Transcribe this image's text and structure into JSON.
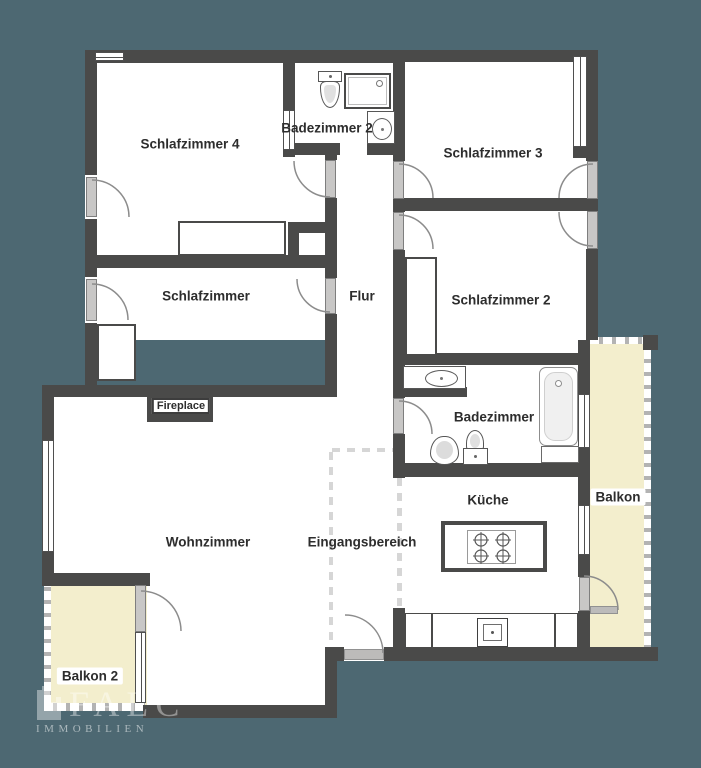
{
  "logo": {
    "name": "FALC",
    "subtitle": "IMMOBILIEN"
  },
  "colors": {
    "background": "#4d6872",
    "wall": "#4a4a49",
    "floor": "#ffffff",
    "balcony": "#f3eecd",
    "door_panel": "#c8c7c6",
    "label_text": "#2d2d2d"
  },
  "floorplan": {
    "floor_areas": [
      [
        85,
        50,
        513,
        290
      ],
      [
        393,
        340,
        197,
        321
      ],
      [
        325,
        340,
        80,
        321
      ],
      [
        54,
        385,
        283,
        320
      ]
    ],
    "balconies": [
      {
        "id": "balkon",
        "rect": [
          590,
          344,
          54,
          303
        ]
      },
      {
        "id": "balkon-2",
        "rect": [
          44,
          578,
          103,
          127
        ]
      }
    ],
    "open_edges": [
      {
        "axis": "h",
        "rect": [
          590,
          337,
          53,
          7
        ]
      },
      {
        "axis": "v",
        "rect": [
          644,
          337,
          7,
          310
        ]
      },
      {
        "axis": "v",
        "rect": [
          44,
          578,
          7,
          127
        ]
      },
      {
        "axis": "h",
        "rect": [
          44,
          703,
          101,
          8
        ]
      }
    ],
    "open_boundaries": [
      {
        "axis": "v",
        "rect": [
          329,
          452,
          4,
          192
        ]
      },
      {
        "axis": "h",
        "rect": [
          332,
          448,
          66,
          4
        ]
      },
      {
        "axis": "v",
        "rect": [
          397,
          478,
          5,
          130
        ]
      }
    ],
    "walls": [
      [
        85,
        50,
        315,
        13
      ],
      [
        393,
        50,
        205,
        12
      ],
      [
        283,
        143,
        57,
        12
      ],
      [
        367,
        144,
        33,
        11
      ],
      [
        393,
        198,
        205,
        13
      ],
      [
        288,
        222,
        49,
        11
      ],
      [
        85,
        255,
        252,
        13
      ],
      [
        42,
        385,
        295,
        12
      ],
      [
        393,
        353,
        195,
        12
      ],
      [
        393,
        387,
        74,
        10
      ],
      [
        393,
        463,
        197,
        14
      ],
      [
        325,
        647,
        19,
        14
      ],
      [
        384,
        647,
        274,
        14
      ],
      [
        143,
        705,
        194,
        13
      ],
      [
        42,
        573,
        108,
        13
      ],
      [
        573,
        147,
        25,
        11
      ],
      [
        643,
        335,
        15,
        15
      ],
      [
        85,
        50,
        12,
        125
      ],
      [
        85,
        219,
        12,
        58
      ],
      [
        85,
        323,
        12,
        74
      ],
      [
        42,
        385,
        12,
        55
      ],
      [
        42,
        552,
        12,
        33
      ],
      [
        283,
        50,
        12,
        60
      ],
      [
        283,
        147,
        12,
        10
      ],
      [
        288,
        232,
        11,
        25
      ],
      [
        325,
        155,
        12,
        5
      ],
      [
        325,
        198,
        12,
        80
      ],
      [
        325,
        314,
        12,
        83
      ],
      [
        393,
        50,
        12,
        111
      ],
      [
        393,
        199,
        12,
        13
      ],
      [
        393,
        250,
        12,
        148
      ],
      [
        393,
        434,
        12,
        44
      ],
      [
        393,
        608,
        12,
        53
      ],
      [
        586,
        50,
        12,
        111
      ],
      [
        586,
        199,
        12,
        12
      ],
      [
        586,
        249,
        12,
        91
      ],
      [
        578,
        340,
        12,
        54
      ],
      [
        578,
        448,
        12,
        57
      ],
      [
        578,
        555,
        12,
        22
      ],
      [
        578,
        611,
        12,
        50
      ],
      [
        325,
        647,
        12,
        71
      ]
    ],
    "windows": [
      {
        "axis": "h",
        "rect": [
          95,
          52,
          29,
          9
        ]
      },
      {
        "axis": "v",
        "rect": [
          42,
          440,
          12,
          112
        ]
      },
      {
        "axis": "v",
        "rect": [
          283,
          110,
          12,
          40
        ]
      },
      {
        "axis": "v",
        "rect": [
          578,
          394,
          12,
          54
        ]
      },
      {
        "axis": "v",
        "rect": [
          578,
          505,
          12,
          50
        ]
      },
      {
        "axis": "v",
        "rect": [
          135,
          632,
          11,
          71
        ]
      },
      {
        "axis": "v",
        "rect": [
          573,
          56,
          14,
          91
        ]
      }
    ],
    "sills": [
      [
        344,
        649,
        40,
        11
      ],
      [
        590,
        606,
        28,
        8
      ]
    ],
    "doors": [
      {
        "id": "schlafzimmer4-exterior",
        "panel": [
          86,
          177,
          11,
          40
        ],
        "arc": "M92,180 A37,37 0 0 1 129,217"
      },
      {
        "id": "flur-schlafzimmer4",
        "panel": [
          325,
          160,
          11,
          38
        ],
        "arc": "M294,161 A36,36 0 0 0 330,197"
      },
      {
        "id": "flur-schlafzimmer3",
        "panel": [
          393,
          161,
          11,
          38
        ],
        "arc": "M399,164 A34,34 0 0 1 433,198"
      },
      {
        "id": "flur-schlafzimmer2",
        "panel": [
          393,
          212,
          11,
          38
        ],
        "arc": "M399,215 A34,34 0 0 1 433,249"
      },
      {
        "id": "schlafzimmer3-right",
        "panel": [
          587,
          161,
          11,
          38
        ],
        "arc": "M559,198 A34,34 0 0 1 593,164"
      },
      {
        "id": "schlafzimmer2-right",
        "panel": [
          587,
          211,
          11,
          38
        ],
        "arc": "M593,246 A34,34 0 0 1 559,212"
      },
      {
        "id": "schlafzimmer-exterior",
        "panel": [
          86,
          279,
          11,
          42
        ],
        "arc": "M92,284 A36,36 0 0 1 128,320"
      },
      {
        "id": "flur-schlafzimmer",
        "panel": [
          325,
          278,
          11,
          36
        ],
        "arc": "M330,312 A33,33 0 0 1 297,279"
      },
      {
        "id": "flur-badezimmer",
        "panel": [
          393,
          398,
          11,
          36
        ],
        "arc": "M399,401 A33,33 0 0 1 432,434"
      },
      {
        "id": "wohnzimmer-balkon2",
        "panel": [
          135,
          585,
          11,
          47
        ],
        "arc": "M141,591 A40,40 0 0 1 181,631"
      },
      {
        "id": "kueche-balkon",
        "panel": [
          579,
          577,
          11,
          34
        ],
        "arc": "M584,576 A34,34 0 0 1 618,610"
      },
      {
        "id": "entrance",
        "panel": null,
        "arc": "M345,615 A38,38 0 0 1 383,653"
      }
    ],
    "fixtures": [
      {
        "id": "badezimmer2-toilet",
        "type": "toilet-tank",
        "rect": [
          318,
          71,
          24,
          37
        ]
      },
      {
        "id": "badezimmer2-shower",
        "type": "shower",
        "rect": [
          344,
          73,
          47,
          36
        ]
      },
      {
        "id": "badezimmer2-sink",
        "type": "sink",
        "rect": [
          367,
          111,
          28,
          33
        ],
        "oval": [
          371,
          117,
          20,
          22
        ]
      },
      {
        "id": "schlafzimmer4-wardrobe",
        "type": "wardrobe",
        "rect": [
          178,
          221,
          108,
          35
        ]
      },
      {
        "id": "schlafzimmer-wardrobe",
        "type": "wardrobe",
        "rect": [
          97,
          324,
          39,
          57
        ]
      },
      {
        "id": "schlafzimmer2-wardrobe",
        "type": "wardrobe",
        "rect": [
          405,
          257,
          32,
          99
        ]
      },
      {
        "id": "badezimmer-basin",
        "type": "sink",
        "rect": [
          403,
          366,
          63,
          23
        ],
        "oval": [
          424,
          369,
          33,
          17
        ]
      },
      {
        "id": "badezimmer-toilet",
        "type": "toilet",
        "rect": [
          430,
          436,
          29,
          29
        ]
      },
      {
        "id": "badezimmer-bidet",
        "type": "bidet",
        "rect": [
          463,
          430,
          25,
          35
        ]
      },
      {
        "id": "badezimmer-bathtub",
        "type": "bathtub",
        "rect": [
          539,
          367,
          39,
          79
        ]
      },
      {
        "id": "badezimmer-cabinet",
        "type": "cabinet",
        "rect": [
          541,
          446,
          38,
          17
        ]
      },
      {
        "id": "kueche-island",
        "type": "island",
        "rect": [
          441,
          521,
          106,
          51
        ]
      },
      {
        "id": "kueche-counter",
        "type": "counter",
        "rect": [
          405,
          613,
          173,
          35
        ],
        "dividers": [
          430,
          553
        ],
        "sink": [
          476,
          617,
          31,
          29
        ]
      },
      {
        "id": "fireplace-block",
        "type": "fireplace",
        "rect": [
          147,
          393,
          66,
          29
        ]
      }
    ],
    "labels": [
      {
        "id": "schlafzimmer-4",
        "text": "Schlafzimmer 4",
        "x": 190,
        "y": 144
      },
      {
        "id": "badezimmer-2",
        "text": "Badezimmer 2",
        "x": 327,
        "y": 128
      },
      {
        "id": "schlafzimmer-3",
        "text": "Schlafzimmer 3",
        "x": 493,
        "y": 153
      },
      {
        "id": "schlafzimmer",
        "text": "Schlafzimmer",
        "x": 206,
        "y": 296
      },
      {
        "id": "flur",
        "text": "Flur",
        "x": 362,
        "y": 296
      },
      {
        "id": "schlafzimmer-2",
        "text": "Schlafzimmer 2",
        "x": 501,
        "y": 300
      },
      {
        "id": "badezimmer",
        "text": "Badezimmer",
        "x": 494,
        "y": 417
      },
      {
        "id": "wohnzimmer",
        "text": "Wohnzimmer",
        "x": 208,
        "y": 542
      },
      {
        "id": "eingangsbereich",
        "text": "Eingangsbereich",
        "x": 362,
        "y": 542
      },
      {
        "id": "kueche",
        "text": "Küche",
        "x": 488,
        "y": 500
      },
      {
        "id": "balkon",
        "text": "Balkon",
        "x": 618,
        "y": 497,
        "style": "pill"
      },
      {
        "id": "balkon-2",
        "text": "Balkon 2",
        "x": 90,
        "y": 676,
        "style": "pill"
      },
      {
        "id": "fireplace",
        "text": "Fireplace",
        "x": 181,
        "y": 406,
        "style": "outlined-box"
      }
    ]
  }
}
